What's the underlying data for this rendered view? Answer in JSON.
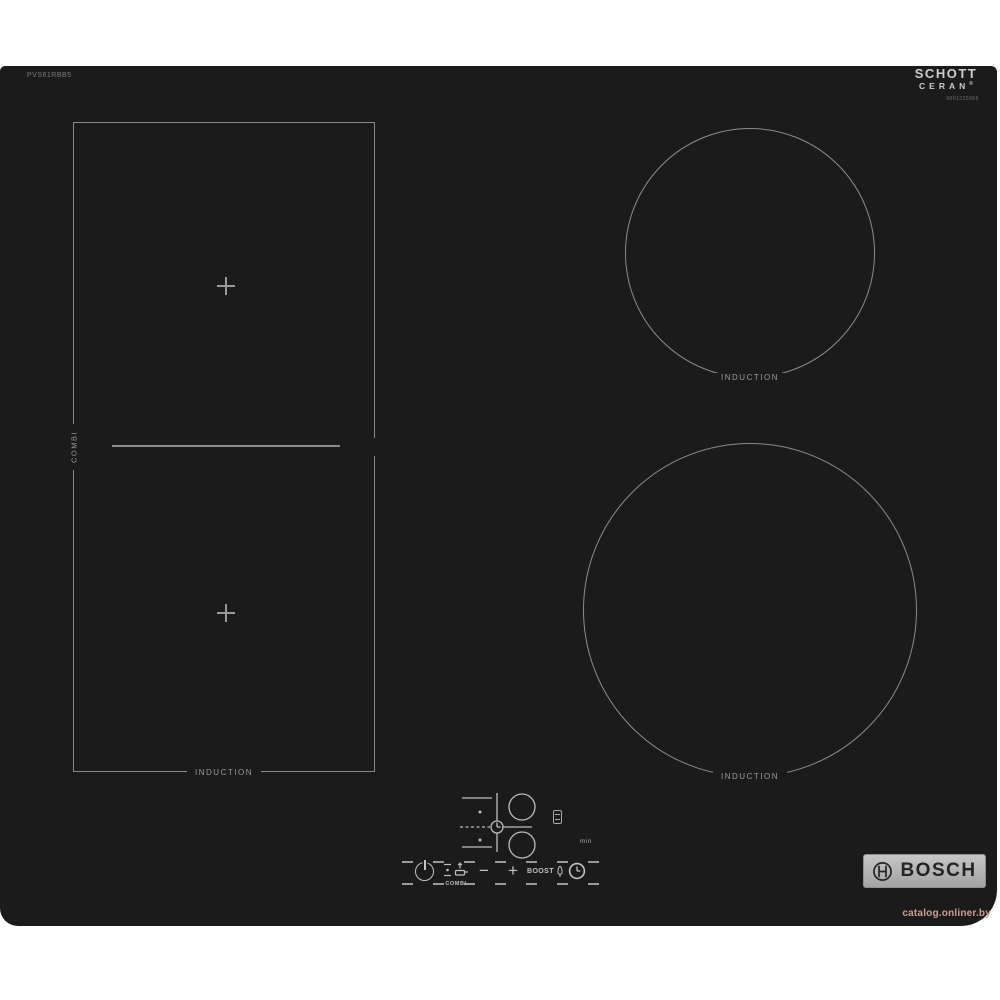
{
  "cooktop": {
    "background": "#1b1b1b",
    "line_color": "#8d8d8d",
    "model_number": "PVS61RBB5",
    "schott": {
      "line1": "SCHOTT",
      "line2": "CERAN",
      "registered": "®",
      "serial": "9001225965"
    },
    "zones": {
      "combi": {
        "side_label": "COMBI",
        "bottom_label": "INDUCTION"
      },
      "top_right": {
        "label": "INDUCTION"
      },
      "bottom_right": {
        "label": "INDUCTION"
      }
    },
    "controls": {
      "combi_label": "COMBI",
      "minus_label": "−",
      "plus_label": "+",
      "boost_label": "BOOST",
      "min_label": "min"
    },
    "bosch": {
      "text": "BOSCH"
    }
  },
  "watermark": {
    "text": "catalog.onliner.by",
    "color": "#cf9e92"
  }
}
